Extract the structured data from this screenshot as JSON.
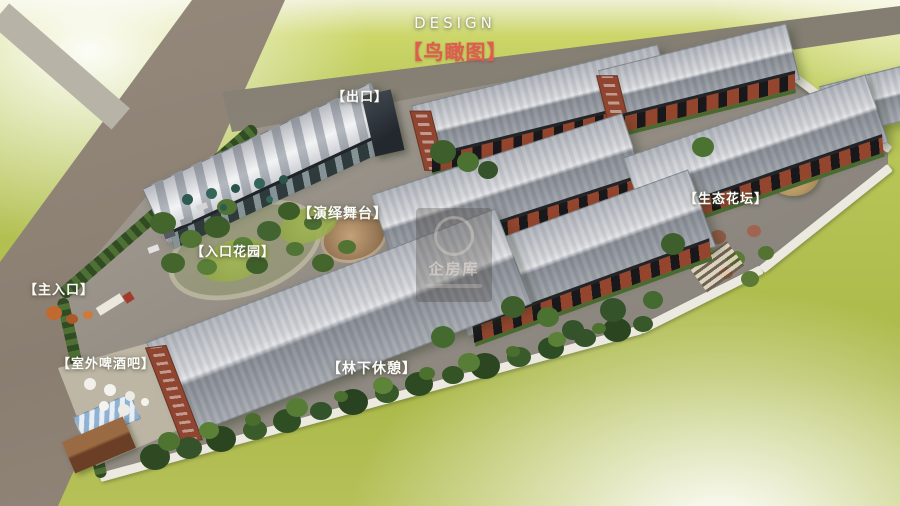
{
  "scene": {
    "type": "aerial architectural rendering (bird's-eye view of a creative industrial park)"
  },
  "header": {
    "design_label": "DESIGN",
    "title": "【鸟瞰图】"
  },
  "annotations": [
    {
      "id": "exit",
      "label": "【出口】"
    },
    {
      "id": "performance-stage",
      "label": "【演绎舞台】"
    },
    {
      "id": "entrance-garden",
      "label": "【入口花园】"
    },
    {
      "id": "main-entrance",
      "label": "【主入口】"
    },
    {
      "id": "outdoor-beer-bar",
      "label": "【室外啤酒吧】"
    },
    {
      "id": "forest-rest",
      "label": "【林下休憩】"
    },
    {
      "id": "eco-flower-bed",
      "label": "【生态花坛】"
    }
  ],
  "watermark": {
    "text": "企房库"
  },
  "colors": {
    "title_red": "#de5d4e",
    "label_white": "#fdfdf8",
    "grass_green": "#b3c153",
    "roof_gray": "#b7bac1",
    "brick_red": "#93452e",
    "road_gray": "#8a7e71",
    "wall_white": "#ece9e0",
    "tree_green": "#33522a"
  }
}
